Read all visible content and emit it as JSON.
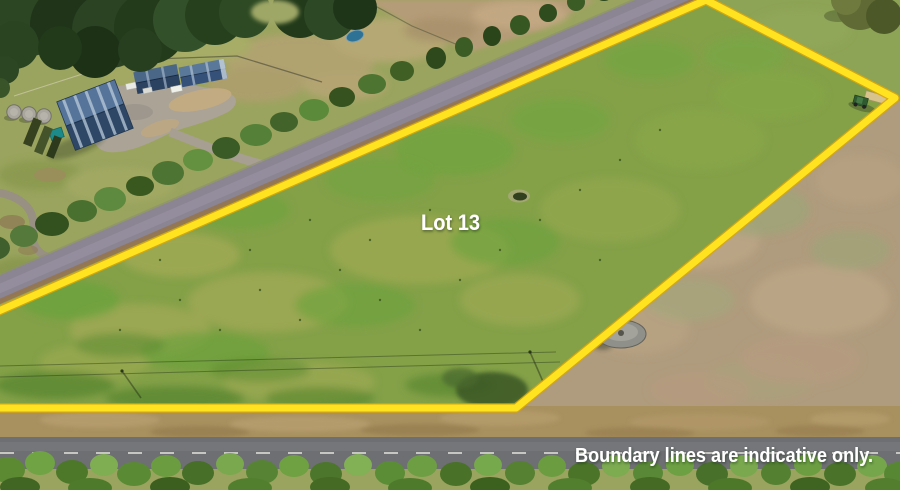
{
  "photo": {
    "type": "aerial-property-listing-photo",
    "lot_label": "Lot 13",
    "disclaimer": "Boundary lines are indicative only.",
    "boundary_color": "#ffe320",
    "label_color": "#ffffff",
    "visible_features": [
      "green pasture lot outlined in yellow",
      "sealed road along upper-left boundary with tree row",
      "farm sheds with blue roofs and gravel yard top-left",
      "round water tanks beside sheds",
      "dry tan paddock to the right of the boundary",
      "round concrete tank outside lower boundary",
      "tractor near top-right corner inside lot",
      "small pond inside lot",
      "tree-lined road across the bottom"
    ]
  }
}
